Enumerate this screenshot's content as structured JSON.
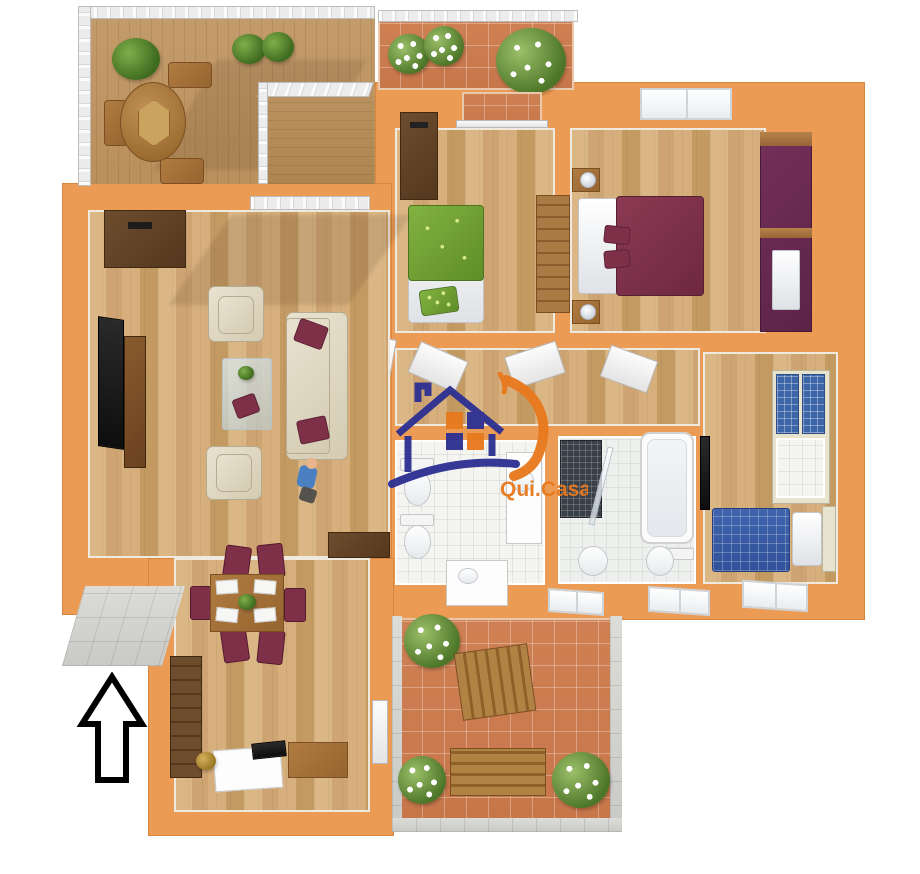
{
  "meta": {
    "image_type": "3d-rendered-apartment-floor-plan",
    "background": "#ffffff"
  },
  "watermark": {
    "brand_text": "Qui.Casa",
    "house_icon": "house-outline-with-window",
    "text_color": "#e8791e",
    "house_color": "#2e3192",
    "swoosh_color": "#e8791e"
  },
  "north_arrow": {
    "icon": "up-arrow-outline",
    "direction": "up",
    "stroke_color": "#000000",
    "fill_color": "#ffffff"
  },
  "palette": {
    "wall_orange": "#ec9b55",
    "wall_orange_dark": "#d8863e",
    "burgundy": "#7e3049",
    "purple_wardrobe": "#6e2d52",
    "green_bed": "#7cae3e",
    "blue_duvet": "#3c5fa8",
    "wood_light": "#d9b586",
    "terracotta": "#cd8052",
    "deck_wood": "#c49c6b",
    "tile_white": "#f4f4f1",
    "gray_tile": "#d8d8d6",
    "cream_sofa": "#e3dcc8",
    "dark_wood": "#6b4a2b"
  },
  "rooms": [
    {
      "name": "roof-terrace",
      "floor": "wood-deck",
      "furniture": [
        "round-dining-table",
        "four-chairs",
        "plants",
        "white-railing",
        "balcony-niche"
      ]
    },
    {
      "name": "front-balcony",
      "floor": "terracotta-tile",
      "furniture": [
        "flower-pots",
        "white-railing"
      ]
    },
    {
      "name": "kids-bedroom",
      "floor": "wood",
      "furniture": [
        "single-bed-green",
        "wardrobe-dark",
        "dresser"
      ]
    },
    {
      "name": "master-bedroom",
      "floor": "wood",
      "furniture": [
        "double-bed-burgundy",
        "nightstands",
        "lamps",
        "purple-wardrobe",
        "window"
      ]
    },
    {
      "name": "hallway",
      "floor": "wood",
      "furniture": [
        "open-doors"
      ]
    },
    {
      "name": "bathroom-left",
      "floor": "white-tile",
      "furniture": [
        "toilet",
        "bidet",
        "vanity-sink",
        "cabinet"
      ]
    },
    {
      "name": "bathroom-right",
      "floor": "white-tile",
      "furniture": [
        "shower",
        "bathtub",
        "toilet",
        "bidet"
      ]
    },
    {
      "name": "study-bedroom",
      "floor": "wood",
      "furniture": [
        "bookshelf-blue-glass",
        "single-bed-blue",
        "wall-tv",
        "window"
      ]
    },
    {
      "name": "living-room",
      "floor": "wood",
      "furniture": [
        "sofa-cream",
        "two-armchairs",
        "glass-coffee-table",
        "tv-wall-unit",
        "entry-cabinet",
        "child-figure"
      ]
    },
    {
      "name": "dining-study-room",
      "floor": "wood",
      "furniture": [
        "dining-table",
        "six-burgundy-chairs",
        "desk-with-computer",
        "sideboard",
        "tall-cabinet"
      ]
    },
    {
      "name": "lower-terrace",
      "floor": "terracotta-tile",
      "furniture": [
        "wooden-bench",
        "wooden-table",
        "flower-bushes"
      ]
    },
    {
      "name": "entry-porch",
      "floor": "gray-tile",
      "furniture": []
    }
  ]
}
